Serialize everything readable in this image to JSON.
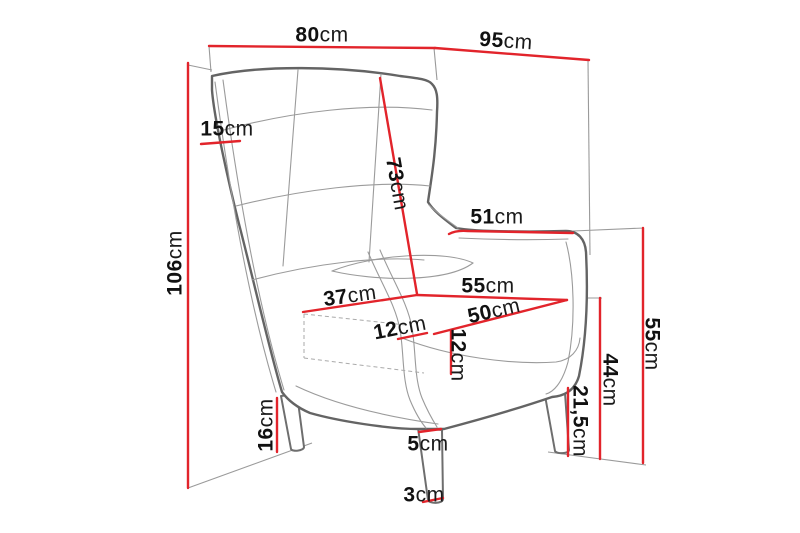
{
  "figure": {
    "background_color": "#ffffff",
    "accent_red": "#e2242b",
    "outline_gray": "#6e6e6e",
    "seam_gray": "#9b9b9b"
  },
  "dims": [
    {
      "id": "front-width",
      "value": "80",
      "unit": "cm"
    },
    {
      "id": "side-depth",
      "value": "95",
      "unit": "cm"
    },
    {
      "id": "wing-thickness",
      "value": "15",
      "unit": "cm"
    },
    {
      "id": "backrest-diagonal",
      "value": "73",
      "unit": "cm"
    },
    {
      "id": "total-height",
      "value": "106",
      "unit": "cm"
    },
    {
      "id": "armrest-length",
      "value": "51",
      "unit": "cm"
    },
    {
      "id": "seat-width-back",
      "value": "55",
      "unit": "cm"
    },
    {
      "id": "seat-width-front",
      "value": "50",
      "unit": "cm"
    },
    {
      "id": "armrest-width",
      "value": "12",
      "unit": "cm"
    },
    {
      "id": "seat-cushion-thickness",
      "value": "12",
      "unit": "cm"
    },
    {
      "id": "seat-depth",
      "value": "37",
      "unit": "cm"
    },
    {
      "id": "seat-height",
      "value": "44",
      "unit": "cm"
    },
    {
      "id": "armrest-height",
      "value": "55",
      "unit": "cm"
    },
    {
      "id": "under-seat-clearance",
      "value": "21,5",
      "unit": "cm"
    },
    {
      "id": "front-left-leg-height",
      "value": "16",
      "unit": "cm"
    },
    {
      "id": "leg-top-width",
      "value": "5",
      "unit": "cm"
    },
    {
      "id": "leg-bottom-width",
      "value": "3",
      "unit": "cm"
    }
  ]
}
